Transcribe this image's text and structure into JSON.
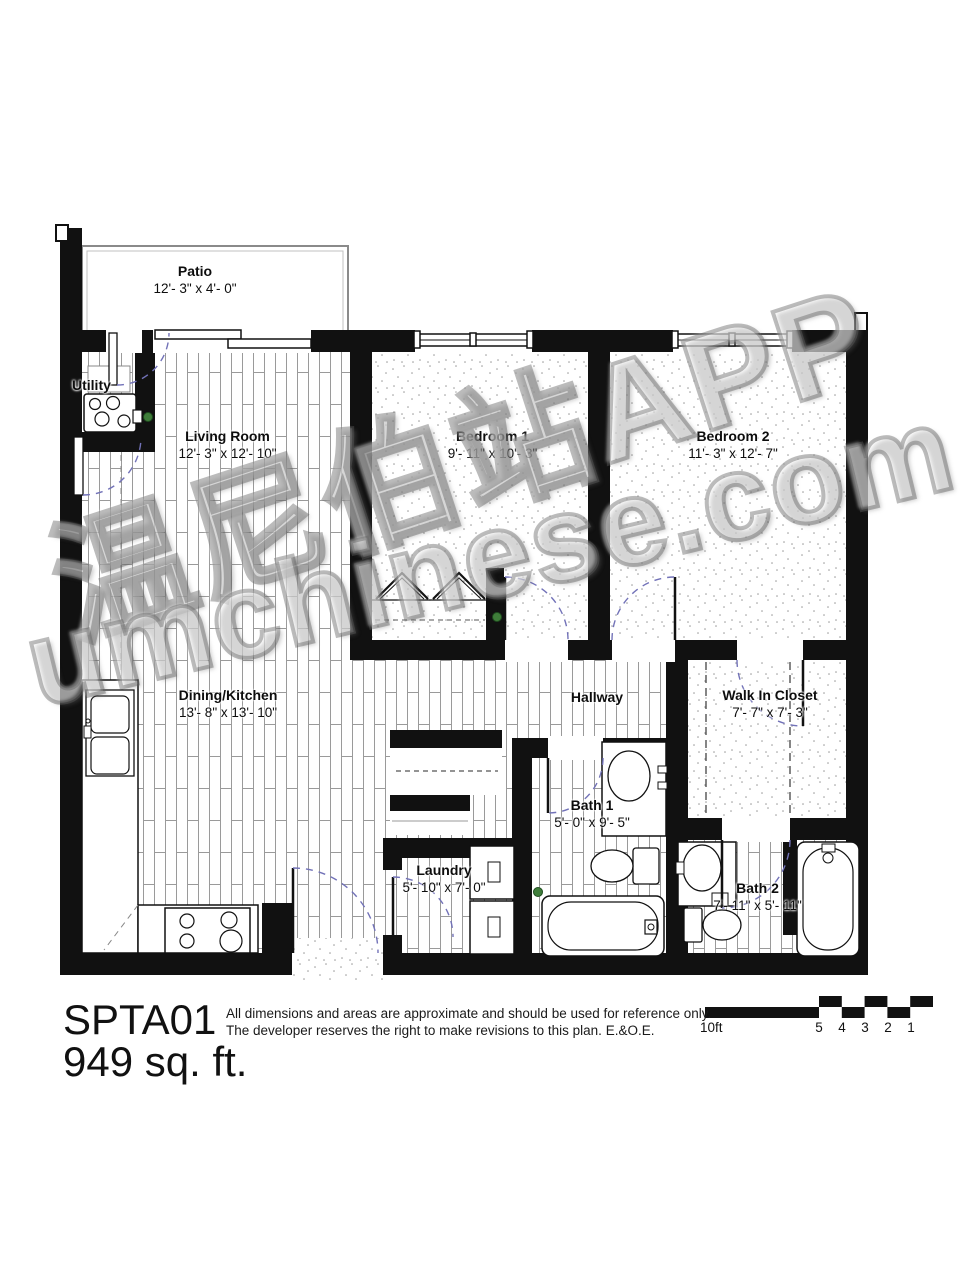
{
  "footer": {
    "plan_code": "SPTA01",
    "area": "949 sq. ft.",
    "disclaimer_line1": "All dimensions and areas are approximate and should be used for reference only.",
    "disclaimer_line2": "The developer reserves the right to make revisions to this plan.  E.&O.E."
  },
  "watermark": {
    "line1": "温尼伯站APP",
    "line2": "umchinese.com"
  },
  "rooms": {
    "patio": {
      "name": "Patio",
      "dims": "12'- 3\" x 4'- 0\""
    },
    "utility": {
      "name": "Utility",
      "dims": ""
    },
    "living": {
      "name": "Living Room",
      "dims": "12'- 3\" x 12'- 10\""
    },
    "bedroom1": {
      "name": "Bedroom 1",
      "dims": "9'- 11\" x 10'- 3\""
    },
    "bedroom2": {
      "name": "Bedroom 2",
      "dims": "11'- 3\" x 12'- 7\""
    },
    "dining_kitchen": {
      "name": "Dining/Kitchen",
      "dims": "13'- 8\" x 13'- 10\""
    },
    "hallway": {
      "name": "Hallway",
      "dims": ""
    },
    "walk_in_closet": {
      "name": "Walk In Closet",
      "dims": "7'- 7\" x 7'- 3\""
    },
    "bath1": {
      "name": "Bath 1",
      "dims": "5'- 0\" x 9'- 5\""
    },
    "laundry": {
      "name": "Laundry",
      "dims": "5'- 10\" x 7'- 0\""
    },
    "bath2": {
      "name": "Bath 2",
      "dims": "7'- 11\" x 5'- 11\""
    }
  },
  "scale_bar": {
    "unit_label": "10ft",
    "ticks": [
      "5",
      "4",
      "3",
      "2",
      "1"
    ]
  },
  "colors": {
    "wall": "#111111",
    "door_arc": "#7272b8",
    "floor_line": "#9a9a9a",
    "sprinkler_green": "#3f7d3a"
  }
}
